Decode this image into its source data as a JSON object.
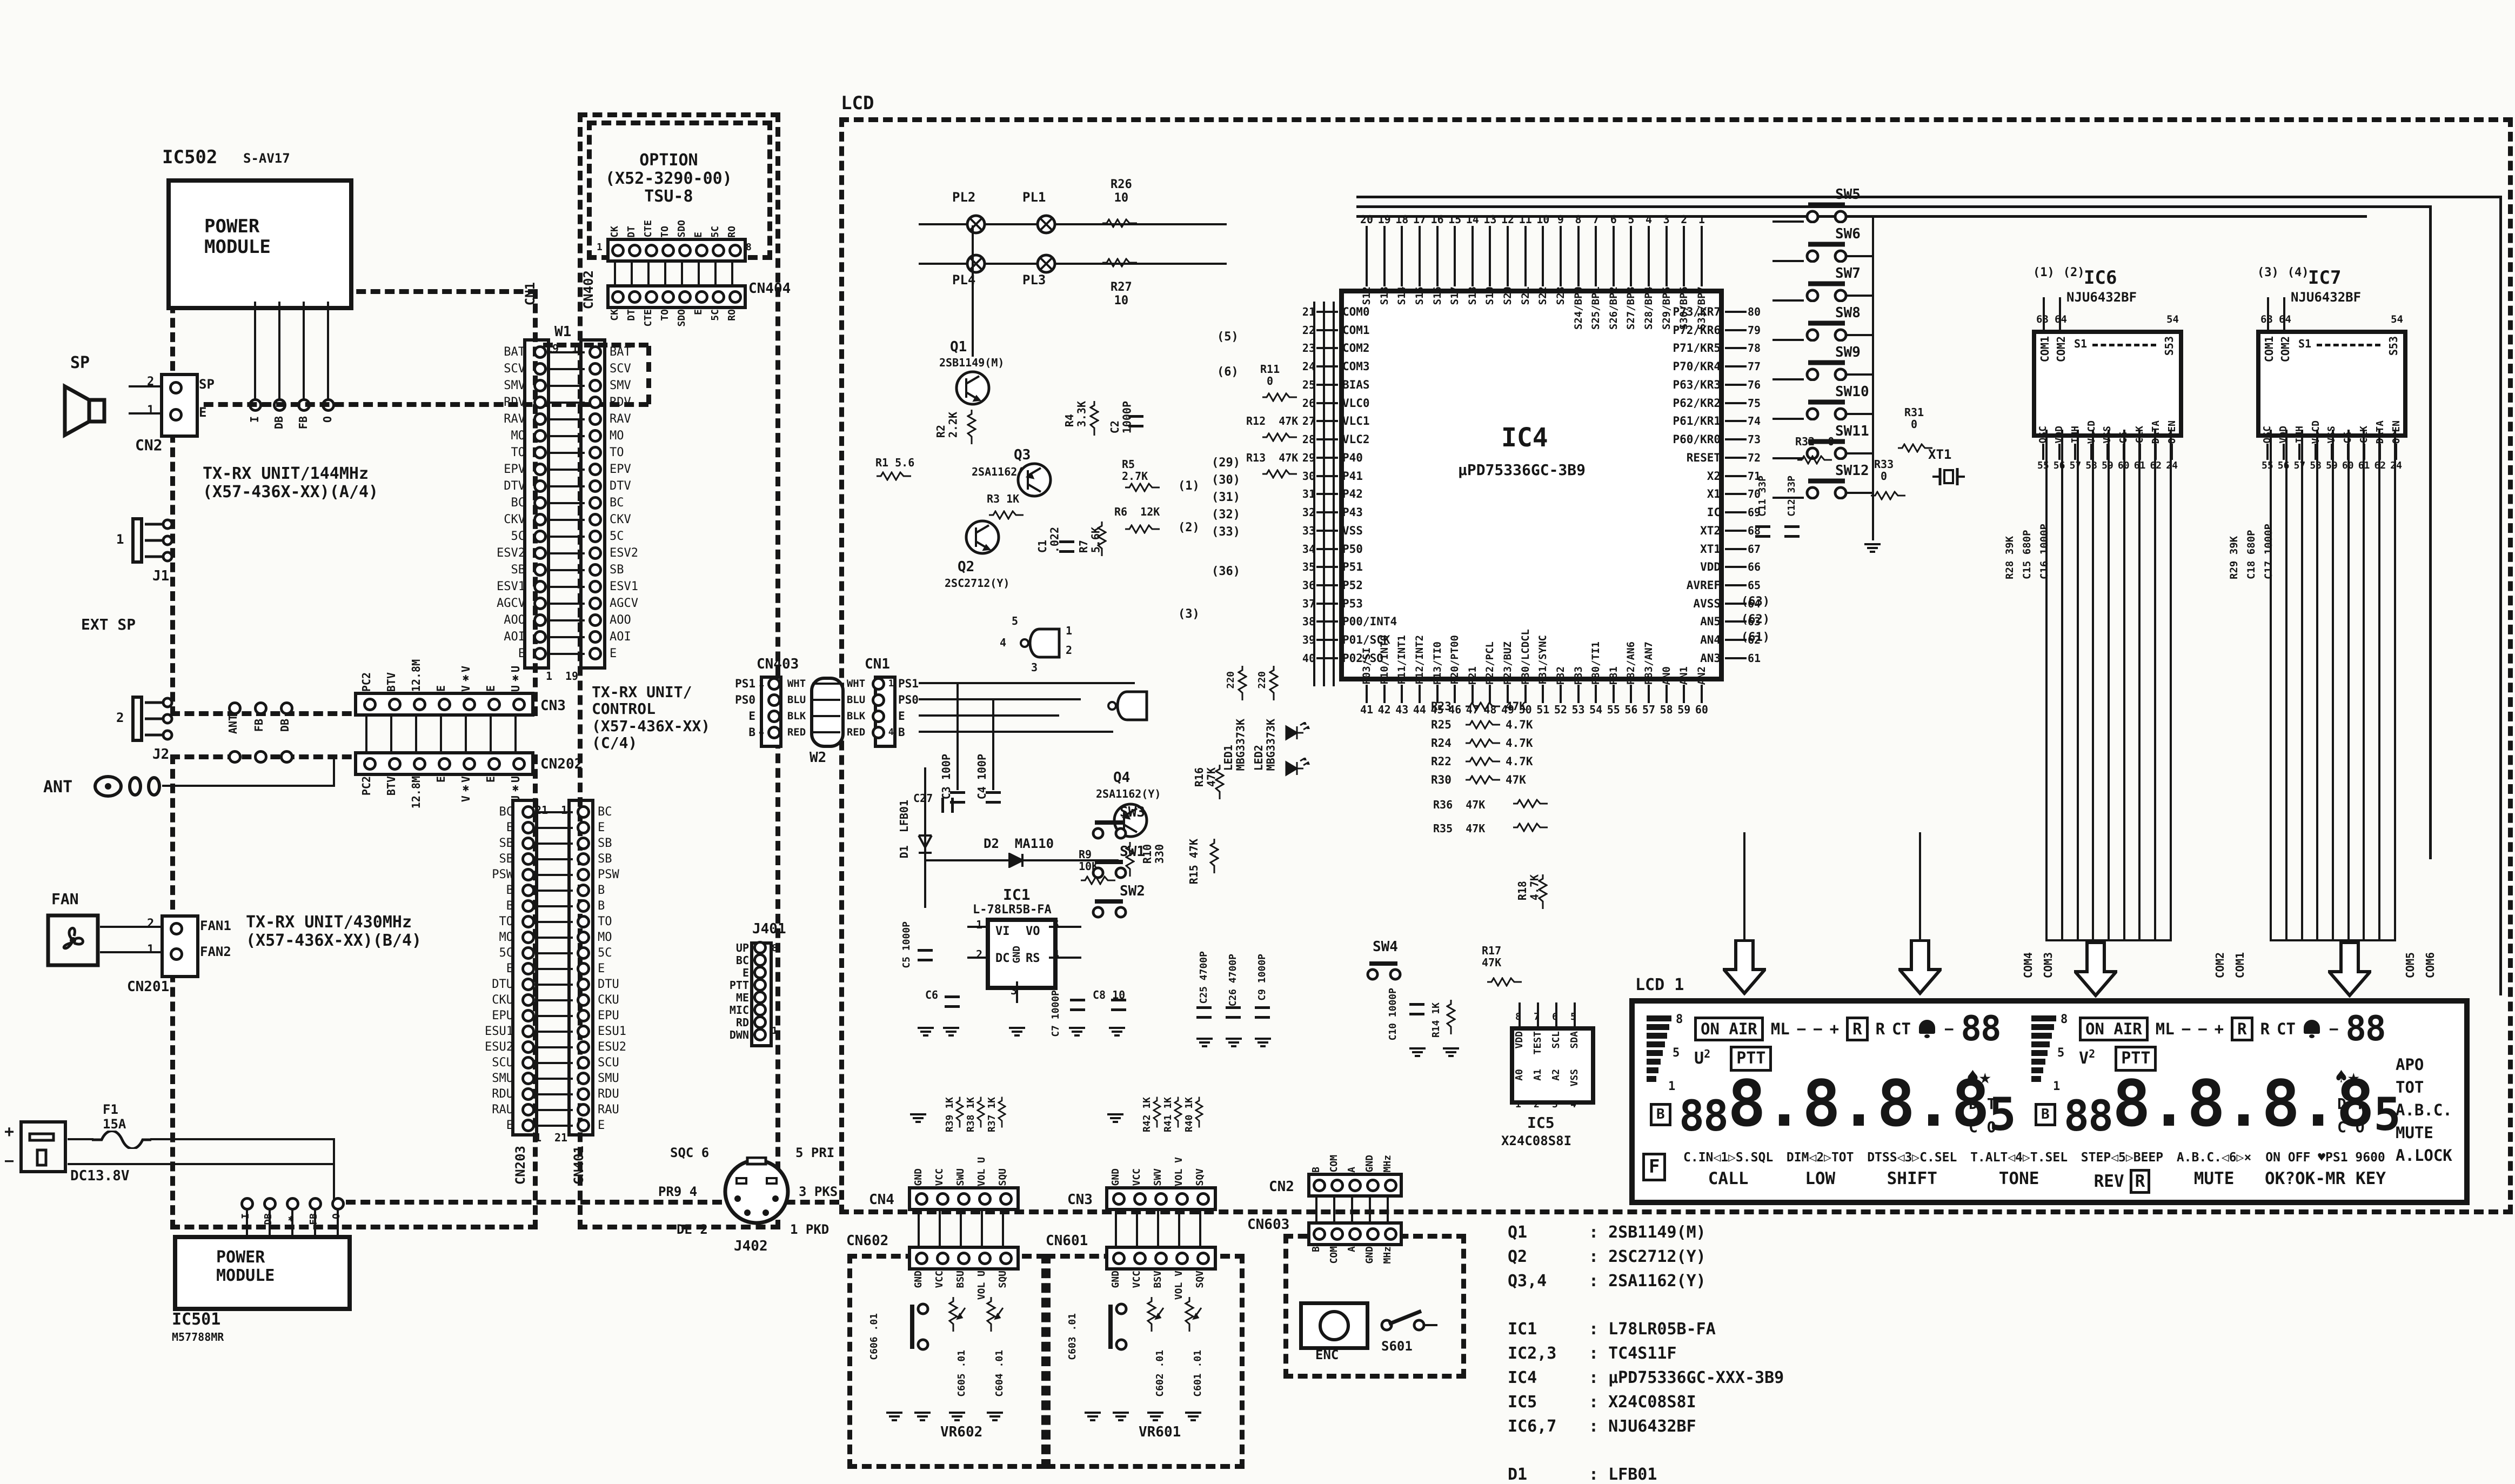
{
  "colors": {
    "ink": "#161616",
    "paper": "#fbfbf8"
  },
  "labels": {
    "ic502": "IC502",
    "s_av17": "S-AV17",
    "power_module": "POWER\nMODULE",
    "ic501": "IC501",
    "m57788mr": "M57788MR",
    "sp": "SP",
    "cn2_top": "CN2",
    "pin1": "1",
    "pin2": "2",
    "sp_pin": "SP",
    "e_pin": "E",
    "j1": "J1",
    "j2": "J2",
    "ext_sp": "EXT SP",
    "one": "1",
    "two": "2",
    "ant": "ANT",
    "ant_tag": "ANT",
    "fb_tag": "FB",
    "db_tag": "DB",
    "unit144": "TX-RX UNIT/144MHz\n(X57-436X-XX)(A/4)",
    "unit430": "TX-RX UNIT/430MHz\n(X57-436X-XX)(B/4)",
    "unit_ctrl": "TX-RX UNIT/\nCONTROL\n(X57-436X-XX)\n(C/4)",
    "option": "OPTION\n(X52-3290-00)\nTSU-8",
    "fan": "FAN",
    "cn201": "CN201",
    "fan1": "FAN1",
    "fan2": "FAN2",
    "f1": "F1\n15A",
    "dc138": "DC13.8V",
    "plus": "+",
    "minus": "−",
    "lcd": "LCD",
    "lcd1_name": "LCD 1",
    "q1": "Q1",
    "q1p": "2SB1149(M)",
    "q2": "Q2",
    "q2p": "2SC2712(Y)",
    "q3": "Q3",
    "q3p": "2SA1162(Y)",
    "q4": "Q4",
    "q4p": "2SA1162(Y)",
    "r1": "R1 5.6",
    "r2": "R2\n2.2K",
    "r3": "R3 1K",
    "r4": "R4\n3.3K",
    "r5": "R5\n2.7K",
    "r6": "R6  12K",
    "r7": "R7\n5.6K",
    "r9": "R9\n10K",
    "r10": "R10\n330",
    "r11": "R11\n0",
    "r12": "R12  47K",
    "r13": "R13  47K",
    "r14": "R14 1K",
    "r15": "R15 47K",
    "r16": "R16\n47K",
    "r17": "R17\n47K",
    "r18": "R18\n4.7K",
    "r20": "220",
    "r21": "220",
    "r26": "R26\n10",
    "r27": "R27\n10",
    "r31": "R31\n0",
    "r32": "R32  0",
    "r33": "R33\n0",
    "r35": "R35  47K",
    "r36": "R36  47K",
    "c1": "C1\n.022",
    "c2": "C2\n1000P",
    "c3": "C3 100P",
    "c4": "C4 100P",
    "c5": "C5 1000P",
    "c6": "C6",
    "c7": "C7 1000P",
    "c8": "C8 10",
    "c9": "C9 1000P",
    "c10": "C10 1000P",
    "c11": "C11 33P",
    "c12": "C12 33P",
    "c25": "C25 4700P",
    "c26": "C26 4700P",
    "c27": "C27",
    "d1": "D1  LFB01",
    "d2": "D2  MA110",
    "led1": "LED1\nMBG3373K",
    "led2": "LED2\nMBG3373K",
    "xt1": "XT1",
    "pl1": "PL1",
    "pl2": "PL2",
    "pl3": "PL3",
    "pl4": "PL4",
    "sw4": "SW4",
    "t5": "(5)",
    "t6": "(6)",
    "t29": "(29)",
    "t30": "(30)",
    "t31": "(31)",
    "t32": "(32)",
    "t33": "(33)",
    "t36": "(36)",
    "t63": "(63)",
    "t62": "(62)",
    "t61": "(61)",
    "w1c": "(1)",
    "w2c": "(2)",
    "w3c": "(3)",
    "g5": "5",
    "g4": "4",
    "g1": "1",
    "g2": "2",
    "g3": "3"
  },
  "ic502_pins": [
    "I",
    "DB",
    "FB",
    "O"
  ],
  "ic501_pins": [
    "I",
    "DB",
    "✱",
    "FB",
    "O"
  ],
  "conn": {
    "cn1w1": {
      "left": "CN1",
      "right": "CN402",
      "jumper": "W1",
      "tl": "19",
      "tr": "1",
      "bl": "1",
      "br": "19",
      "pins": [
        "BAT",
        "SCV",
        "SMV",
        "RDV",
        "RAV",
        "MO",
        "TO",
        "EPV",
        "DTV",
        "BC",
        "CKV",
        "5C",
        "ESV2",
        "SB",
        "ESV1",
        "AGCV",
        "AOO",
        "AOI",
        "E"
      ]
    },
    "cn203": {
      "left": "CN203",
      "right": "CN401",
      "tl": "21",
      "tr": "1",
      "bl": "1",
      "br": "21",
      "pins": [
        "BC",
        "E",
        "SB",
        "SB",
        "PSW",
        "B",
        "B",
        "TO",
        "MO",
        "5C",
        "E",
        "DTU",
        "CKU",
        "EPU",
        "ESU1",
        "ESU2",
        "SCU",
        "SMU",
        "RDU",
        "RAU",
        "E"
      ]
    },
    "cn3202": {
      "top": "CN3",
      "bottom": "CN202",
      "nl": "1",
      "nr": "7",
      "pins": [
        "PC2",
        "BTV",
        "12.8M",
        "E",
        "V✱V",
        "E",
        "U✱U"
      ]
    },
    "cn404": {
      "name": "CN404",
      "nl": "1",
      "nr": "8",
      "pins": [
        "CK",
        "DT",
        "CTE",
        "TO",
        "SDO",
        "E",
        "5C",
        "RO"
      ]
    },
    "cn403": {
      "left": "CN403",
      "right": "CN1",
      "jumper": "W2",
      "rows": [
        {
          "l": "PS1",
          "c": "WHT",
          "r": "PS1",
          "nl": "1",
          "nr": "1"
        },
        {
          "l": "PS0",
          "c": "BLU",
          "r": "PS0",
          "nl": "",
          "nr": ""
        },
        {
          "l": "E",
          "c": "BLK",
          "r": "E",
          "nl": "",
          "nr": ""
        },
        {
          "l": "B",
          "c": "RED",
          "r": "B",
          "nl": "4",
          "nr": "4"
        }
      ]
    },
    "j401": {
      "name": "J401",
      "top": "8",
      "bottom": "1",
      "pins": [
        "UP",
        "BC",
        "E",
        "PTT",
        "ME",
        "MIC",
        "RD",
        "DWN"
      ]
    },
    "j402": {
      "name": "J402",
      "tl": "SQC 6",
      "tr": "5 PRI",
      "ml": "PR9 4",
      "mr": "3 PKS",
      "bl": "DE 2",
      "br": "1 PKD"
    },
    "cn4": {
      "top": "CN4",
      "bottom": "CN602",
      "vr": "VR602",
      "n5": "5",
      "n1": "1",
      "top_pins": [
        "GND",
        "VCC",
        "SWU",
        "VOL U",
        "SQU"
      ],
      "bot_pins": [
        "GND",
        "VCC",
        "BSU",
        "VOL U",
        "SQU"
      ],
      "res": [
        "R39 1K",
        "R38 1K",
        "R37 1K"
      ],
      "caps": [
        "C606 .01",
        "C605 .01",
        "C604 .01"
      ]
    },
    "cn3b": {
      "top": "CN3",
      "bottom": "CN601",
      "vr": "VR601",
      "n5": "5",
      "n1": "1",
      "top_pins": [
        "GND",
        "VCC",
        "SWV",
        "VOL V",
        "SQV"
      ],
      "bot_pins": [
        "GND",
        "VCC",
        "BSV",
        "VOL V",
        "SQV"
      ],
      "res": [
        "R42 1K",
        "R41 1K",
        "R40 1K"
      ],
      "caps": [
        "C603 .01",
        "C602 .01",
        "C601 .01"
      ]
    },
    "cn2b": {
      "top": "CN2",
      "bottom": "CN603",
      "n5": "5",
      "n1": "1",
      "pins": [
        "B",
        "COM",
        "A",
        "GND",
        "MHz"
      ],
      "enc": "ENC",
      "s601": "S601"
    }
  },
  "ic4": {
    "name": "IC4",
    "part": "µPD75336GC-3B9",
    "top": [
      [
        "20",
        "S12"
      ],
      [
        "19",
        "S13"
      ],
      [
        "18",
        "S14"
      ],
      [
        "17",
        "S15"
      ],
      [
        "16",
        "S16"
      ],
      [
        "15",
        "S17"
      ],
      [
        "14",
        "S18"
      ],
      [
        "13",
        "S19"
      ],
      [
        "12",
        "S20"
      ],
      [
        "11",
        "S21"
      ],
      [
        "10",
        "S22"
      ],
      [
        "9",
        "S23"
      ],
      [
        "8",
        "S24/BP0"
      ],
      [
        "7",
        "S25/BP1"
      ],
      [
        "6",
        "S26/BP2"
      ],
      [
        "5",
        "S27/BP3"
      ],
      [
        "4",
        "S28/BP4"
      ],
      [
        "3",
        "S29/BP5"
      ],
      [
        "2",
        "S30/BP6"
      ],
      [
        "1",
        "S31/BP7"
      ]
    ],
    "left": [
      [
        "21",
        "COM0"
      ],
      [
        "22",
        "COM1"
      ],
      [
        "23",
        "COM2"
      ],
      [
        "24",
        "COM3"
      ],
      [
        "25",
        "BIAS"
      ],
      [
        "26",
        "VLC0"
      ],
      [
        "27",
        "VLC1"
      ],
      [
        "28",
        "VLC2"
      ],
      [
        "29",
        "P40"
      ],
      [
        "30",
        "P41"
      ],
      [
        "31",
        "P42"
      ],
      [
        "32",
        "P43"
      ],
      [
        "33",
        "VSS"
      ],
      [
        "34",
        "P50"
      ],
      [
        "35",
        "P51"
      ],
      [
        "36",
        "P52"
      ],
      [
        "37",
        "P53"
      ],
      [
        "38",
        "P00/INT4"
      ],
      [
        "39",
        "P01/SCK"
      ],
      [
        "40",
        "P02/SO"
      ]
    ],
    "right": [
      [
        "80",
        "P73/KR7"
      ],
      [
        "79",
        "P72/KR6"
      ],
      [
        "78",
        "P71/KR5"
      ],
      [
        "77",
        "P70/KR4"
      ],
      [
        "76",
        "P63/KR3"
      ],
      [
        "75",
        "P62/KR2"
      ],
      [
        "74",
        "P61/KR1"
      ],
      [
        "73",
        "P60/KR0"
      ],
      [
        "72",
        "RESET"
      ],
      [
        "71",
        "X2"
      ],
      [
        "70",
        "X1"
      ],
      [
        "69",
        "IC"
      ],
      [
        "68",
        "XT2"
      ],
      [
        "67",
        "XT1"
      ],
      [
        "66",
        "VDD"
      ],
      [
        "65",
        "AVREF"
      ],
      [
        "64",
        "AVSS"
      ],
      [
        "63",
        "AN5"
      ],
      [
        "62",
        "AN4"
      ],
      [
        "61",
        "AN3"
      ]
    ],
    "bottom": [
      [
        "41",
        "P03/SI"
      ],
      [
        "42",
        "P10/INT0"
      ],
      [
        "43",
        "P11/INT1"
      ],
      [
        "44",
        "P12/INT2"
      ],
      [
        "45",
        "P13/TI0"
      ],
      [
        "46",
        "P20/PT00"
      ],
      [
        "47",
        "P21"
      ],
      [
        "48",
        "P22/PCL"
      ],
      [
        "49",
        "P23/BUZ"
      ],
      [
        "50",
        "P30/LCDCL"
      ],
      [
        "51",
        "P31/SYNC"
      ],
      [
        "52",
        "P32"
      ],
      [
        "53",
        "P33"
      ],
      [
        "54",
        "P80/TI1"
      ],
      [
        "55",
        "P81"
      ],
      [
        "56",
        "P82/AN6"
      ],
      [
        "57",
        "P83/AN7"
      ],
      [
        "58",
        "AN0"
      ],
      [
        "59",
        "AN1"
      ],
      [
        "60",
        "AN2"
      ]
    ]
  },
  "ic67": [
    {
      "t1": "(1)",
      "t2": "(2)",
      "name": "IC6",
      "part": "NJU6432BF",
      "n63": "63",
      "n64": "64",
      "n54": "54",
      "com1": "COM1",
      "com2": "COM2",
      "s1": "S1",
      "s53": "S53",
      "n1": "55",
      "l1": "OSC",
      "n2": "56",
      "l2": "VDD",
      "n3": "57",
      "l3": "INH",
      "n4": "58",
      "l4": "VLCD",
      "n5": "59",
      "l5": "VSS",
      "n6": "60",
      "l6": "CE",
      "n7": "61",
      "l7": "CLK",
      "n8": "62",
      "l8": "DATA",
      "n9": "24",
      "l9": "OPEN",
      "rc": "R28 39K",
      "cc1": "C15 680P",
      "cc2": "C16 1000P"
    },
    {
      "t1": "(3)",
      "t2": "(4)",
      "name": "IC7",
      "part": "NJU6432BF",
      "n63": "63",
      "n64": "64",
      "n54": "54",
      "com1": "COM1",
      "com2": "COM2",
      "s1": "S1",
      "s53": "S53",
      "n1": "55",
      "l1": "OSC",
      "n2": "56",
      "l2": "VDD",
      "n3": "57",
      "l3": "INH",
      "n4": "58",
      "l4": "VLCD",
      "n5": "59",
      "l5": "VSS",
      "n6": "60",
      "l6": "CE",
      "n7": "61",
      "l7": "CLK",
      "n8": "62",
      "l8": "DATA",
      "n9": "24",
      "l9": "OPEN",
      "rc": "R29 39K",
      "cc1": "C18 680P",
      "cc2": "C17 1000P"
    }
  ],
  "ic5": {
    "name": "IC5",
    "part": "X24C08S8I",
    "t1": "8",
    "tl1": "VDD",
    "t2": "7",
    "tl2": "TEST",
    "t3": "6",
    "tl3": "SCL",
    "t4": "5",
    "tl4": "SDA",
    "b1": "1",
    "bl1": "A0",
    "b2": "2",
    "bl2": "A1",
    "b3": "3",
    "bl3": "A2",
    "b4": "4",
    "bl4": "VSS"
  },
  "ic1": {
    "name": "IC1",
    "part": "L-78LR5B-FA",
    "vi": "VI",
    "vo": "VO",
    "dc": "DC",
    "rs": "RS",
    "gnd": "GND",
    "n1": "1",
    "n2": "2",
    "n3": "3",
    "n4": "4",
    "n5": "5"
  },
  "sw_ladder": [
    {
      "n": "SW5"
    },
    {
      "n": "SW6"
    },
    {
      "n": "SW7"
    },
    {
      "n": "SW8"
    },
    {
      "n": "SW9"
    },
    {
      "n": "SW10"
    },
    {
      "n": "SW11"
    },
    {
      "n": "SW12"
    }
  ],
  "sw_small": [
    {
      "n": "SW3"
    },
    {
      "n": "SW1"
    },
    {
      "n": "SW2"
    }
  ],
  "res_block": [
    {
      "r": "R23",
      "v": "47K"
    },
    {
      "r": "R25",
      "v": "4.7K"
    },
    {
      "r": "R24",
      "v": "4.7K"
    },
    {
      "r": "R22",
      "v": "4.7K"
    },
    {
      "r": "R30",
      "v": "47K"
    }
  ],
  "lcd1": {
    "name": "LCD 1",
    "com_tags": [
      "COM4",
      "COM3",
      "COM2",
      "COM1",
      "COM5",
      "COM6"
    ],
    "u": {
      "band": "U",
      "sup": "2",
      "ptt": "PTT",
      "onair": "ON AIR",
      "ml": "ML",
      "m1": "−",
      "m2": "−",
      "pl": "+",
      "rb": "R",
      "r": "R",
      "ct": "CT",
      "am": "−",
      "alarm": "88",
      "mem": "88",
      "digits": "8.8.8.8",
      "half": "5",
      "spade": "♠",
      "star": "★",
      "dt": "D T",
      "co": "C O",
      "b": "B",
      "s8": "8",
      "s5": "5",
      "s1": "1"
    },
    "v": {
      "band": "V",
      "sup": "2",
      "ptt": "PTT",
      "onair": "ON AIR",
      "ml": "ML",
      "m1": "−",
      "m2": "−",
      "pl": "+",
      "rb": "R",
      "r": "R",
      "ct": "CT",
      "am": "−",
      "alarm": "88",
      "mem": "88",
      "digits": "8.8.8.8",
      "half": "5",
      "spade": "♠",
      "star": "★",
      "dt": "D T",
      "co": "C O",
      "b": "B",
      "s8": "8",
      "s5": "5",
      "s1": "1"
    },
    "right_labels": [
      "APO",
      "TOT",
      "A.B.C.",
      "MUTE",
      "A.LOCK"
    ],
    "f": "F",
    "fkeys": [
      {
        "top": "C.IN◁1▷S.SQL",
        "bottom": "CALL",
        "r": ""
      },
      {
        "top": "DIM◁2▷TOT",
        "bottom": "LOW",
        "r": ""
      },
      {
        "top": "DTSS◁3▷C.SEL",
        "bottom": "SHIFT",
        "r": ""
      },
      {
        "top": "T.ALT◁4▷T.SEL",
        "bottom": "TONE",
        "r": ""
      },
      {
        "top": "STEP◁5▷BEEP",
        "bottom": "REV",
        "r": "R"
      },
      {
        "top": "A.B.C.◁6▷×",
        "bottom": "MUTE",
        "r": ""
      },
      {
        "top": "ON OFF ♥PS1 9600",
        "bottom": "OK?OK-MR  KEY",
        "r": ""
      }
    ]
  },
  "parts_q": [
    {
      "ref": "Q1",
      "val": ": 2SB1149(M)"
    },
    {
      "ref": "Q2",
      "val": ": 2SC2712(Y)"
    },
    {
      "ref": "Q3,4",
      "val": ": 2SA1162(Y)"
    }
  ],
  "parts_ic": [
    {
      "ref": "IC1",
      "val": ": L78LR05B-FA"
    },
    {
      "ref": "IC2,3",
      "val": ": TC4S11F"
    },
    {
      "ref": "IC4",
      "val": ": µPD75336GC-XXX-3B9"
    },
    {
      "ref": "IC5",
      "val": ": X24C08S8I"
    },
    {
      "ref": "IC6,7",
      "val": ": NJU6432BF"
    }
  ],
  "parts_d": [
    {
      "ref": "D1",
      "val": ": LFB01"
    },
    {
      "ref": "D2",
      "val": ": MA110"
    },
    {
      "ref": "LED1,2",
      "val": ": MBG3373K"
    }
  ]
}
